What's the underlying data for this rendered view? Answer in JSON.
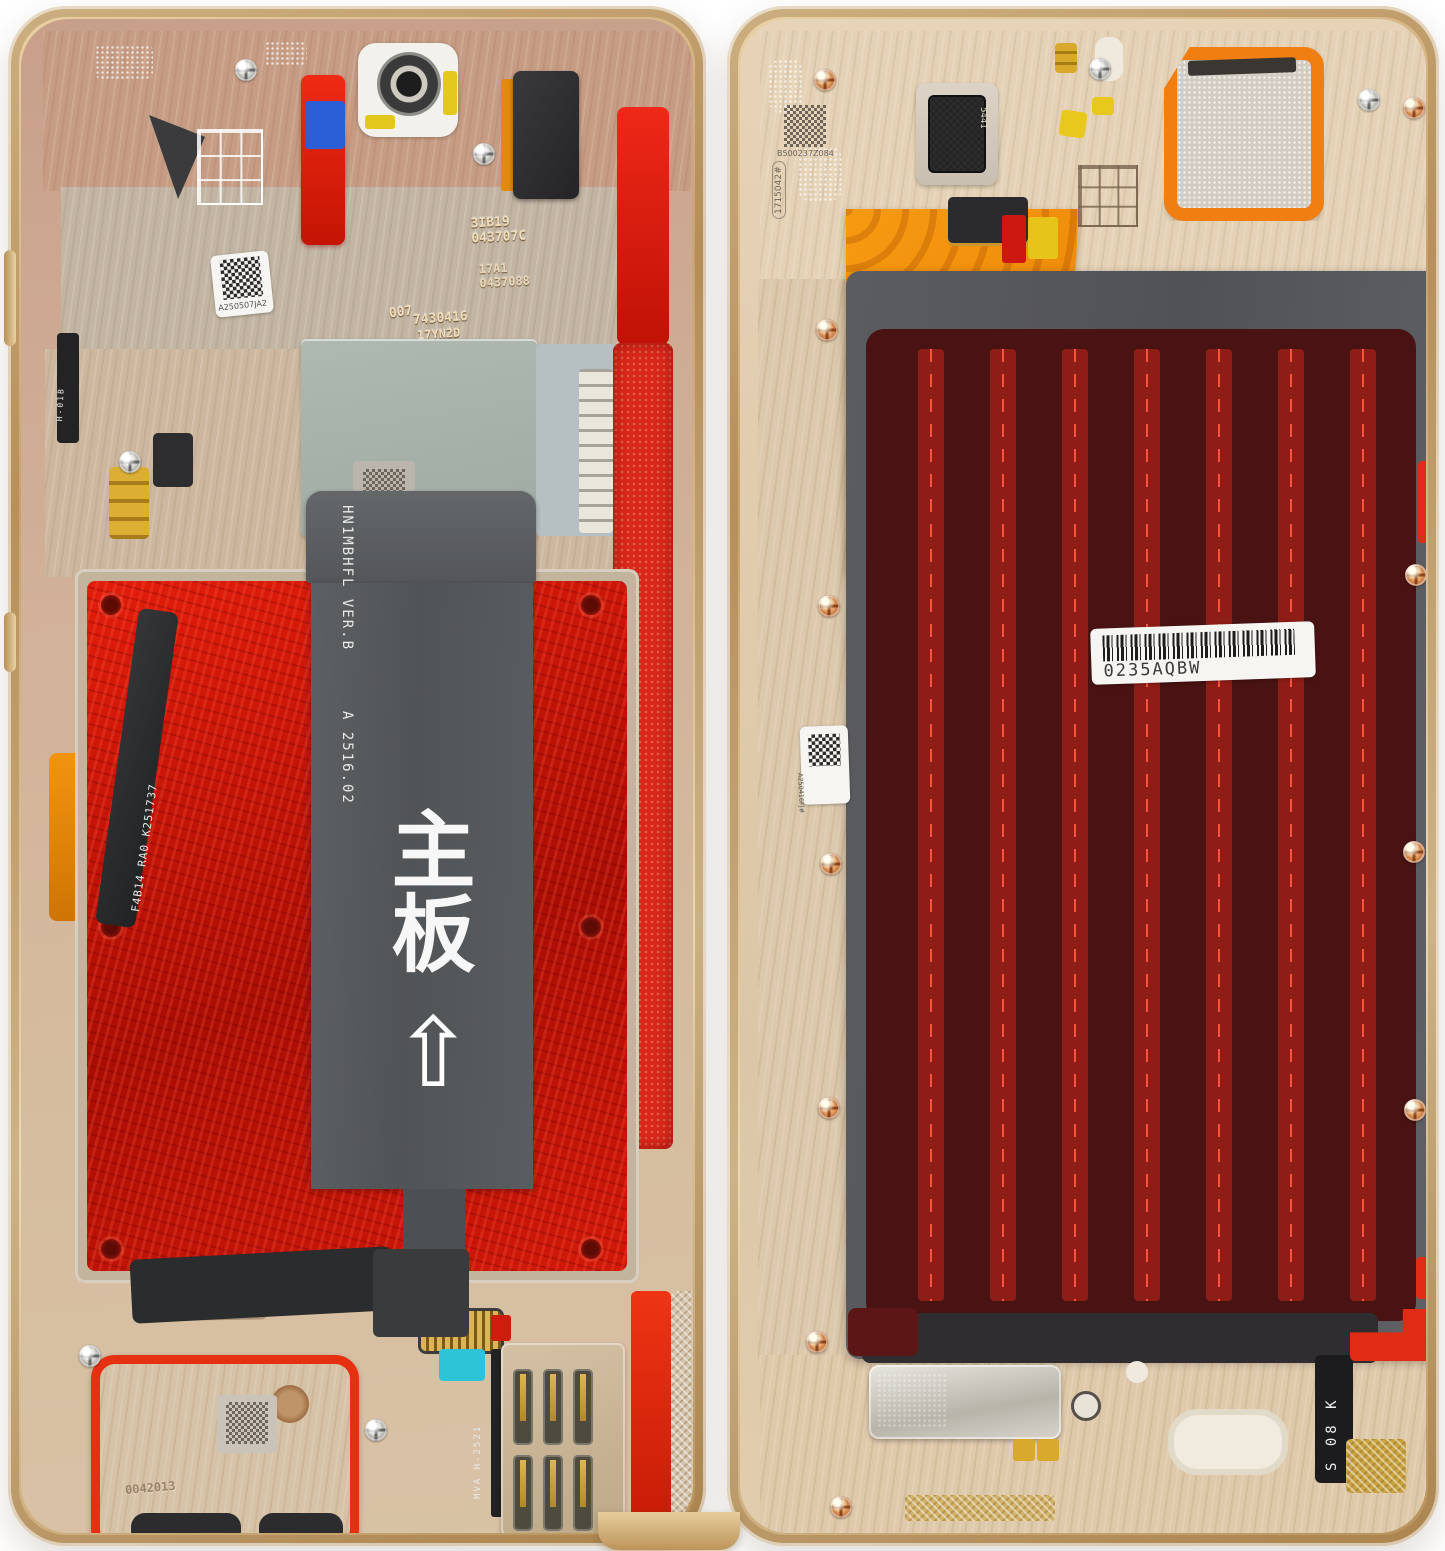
{
  "title": "Disassembled foldable phone internals – two gold halves",
  "left": {
    "qr_top_label": "A250507JA2",
    "etch_007": "007",
    "etch_shield1": "7430416",
    "etch_shield2": "17YN2D",
    "etch_cam1": "3IB19",
    "etch_cam2": "043707C",
    "etch_cam3": "17A1",
    "etch_cam4": "0437088",
    "side_flex_label": "F4B14 RA0 K251737",
    "button_flex_label": "H-01B",
    "main_flex": {
      "model": "HN1MBHFL VER.B",
      "revision": "A 2516.02",
      "cn_text": "主板",
      "arrow": "⇧"
    },
    "bottom_stamp": "07040518",
    "speaker_etch": "0042013",
    "sim_flex_label": "MVA H-2521"
  },
  "right": {
    "qr_top_label": "B500237Z084",
    "side_vertical_label": "1715042#",
    "earpiece_mark": "5441",
    "flex": {
      "model": "HN1MBHFZ01 VB",
      "date_code": "2512 11  mk"
    },
    "barcode_label": "0235AQBW",
    "qr_left_label": "A250416FJ#",
    "corner_label": "S 08 K"
  },
  "colors": {
    "frame_gold": "#d2ab76",
    "battery_red": "#cf1607",
    "adhesive_maroon": "#4a1313",
    "stripe_red": "#8e1d16",
    "flex_orange": "#f08a00",
    "board_grey": "#585a5e"
  }
}
